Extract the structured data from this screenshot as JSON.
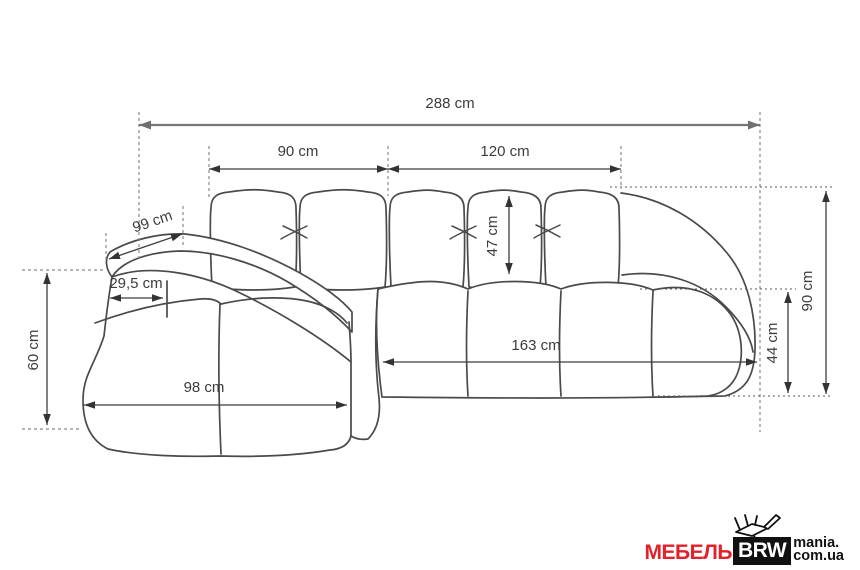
{
  "diagram": {
    "unit": "cm",
    "dimensions": {
      "total_width": "288 cm",
      "back_section_left": "90 cm",
      "back_section_right": "120 cm",
      "side_depth": "99 cm",
      "armrest_width": "29,5 cm",
      "chaise_height": "60 cm",
      "chaise_width": "98 cm",
      "back_cushion_height": "47 cm",
      "seat_width": "163 cm",
      "seat_height": "44 cm",
      "total_height": "90 cm"
    }
  },
  "logo": {
    "brand": "МЕБЕЛЬ",
    "brand_box": "BRW",
    "domain_top": "mania.",
    "domain_bottom": "com.ua"
  },
  "colors": {
    "sofa_outline": "#4a4a4a",
    "dimension_line": "#3d3d3d",
    "overall_dimension_line": "#767676",
    "extension_line": "#8a8a8a",
    "logo_red": "#e3212a",
    "logo_black": "#111111"
  }
}
